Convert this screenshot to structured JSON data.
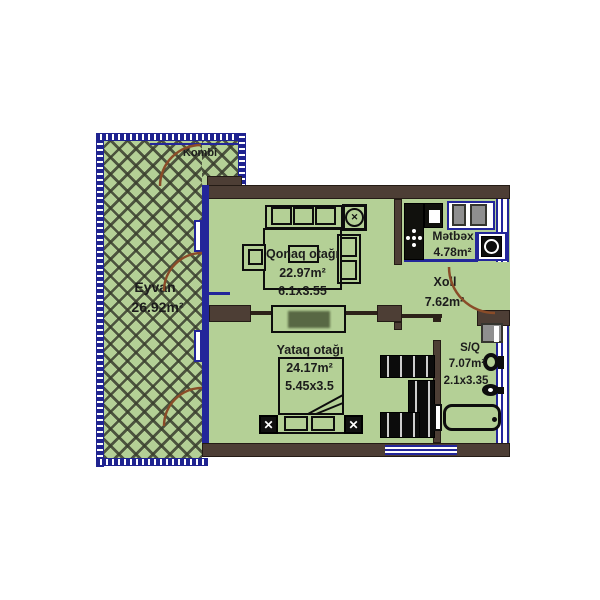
{
  "plan_title": "apartment floor plan",
  "rooms": {
    "eyvan": {
      "name": "Eyvan",
      "area": "26.92m²"
    },
    "kombi": {
      "name": "Kombi"
    },
    "qonaq": {
      "name": "Qonaq otağı",
      "area": "22.97m²",
      "dims": "6.1x3.55"
    },
    "metbex": {
      "name": "Mətbəx",
      "area": "4.78m²"
    },
    "xoll": {
      "name": "Xoll",
      "area": "7.62m²"
    },
    "yataq": {
      "name": "Yataq otağı",
      "area": "24.17m²",
      "dims": "5.45x3.5"
    },
    "sq": {
      "name": "S/Q",
      "area": "7.07m²",
      "dims": "2.1x3.35"
    }
  },
  "colors": {
    "floor": "#b4d096",
    "wall": "#4d3e35",
    "glass_blue": "#23269a",
    "door_arc": "#8a4c28",
    "hatch_line": "#3a3e2e",
    "counter_black": "#11110d",
    "appliance_gray": "#8f8f8f"
  },
  "icons": {
    "fan_glyph": "✕",
    "lamp_glyph": "✕"
  }
}
